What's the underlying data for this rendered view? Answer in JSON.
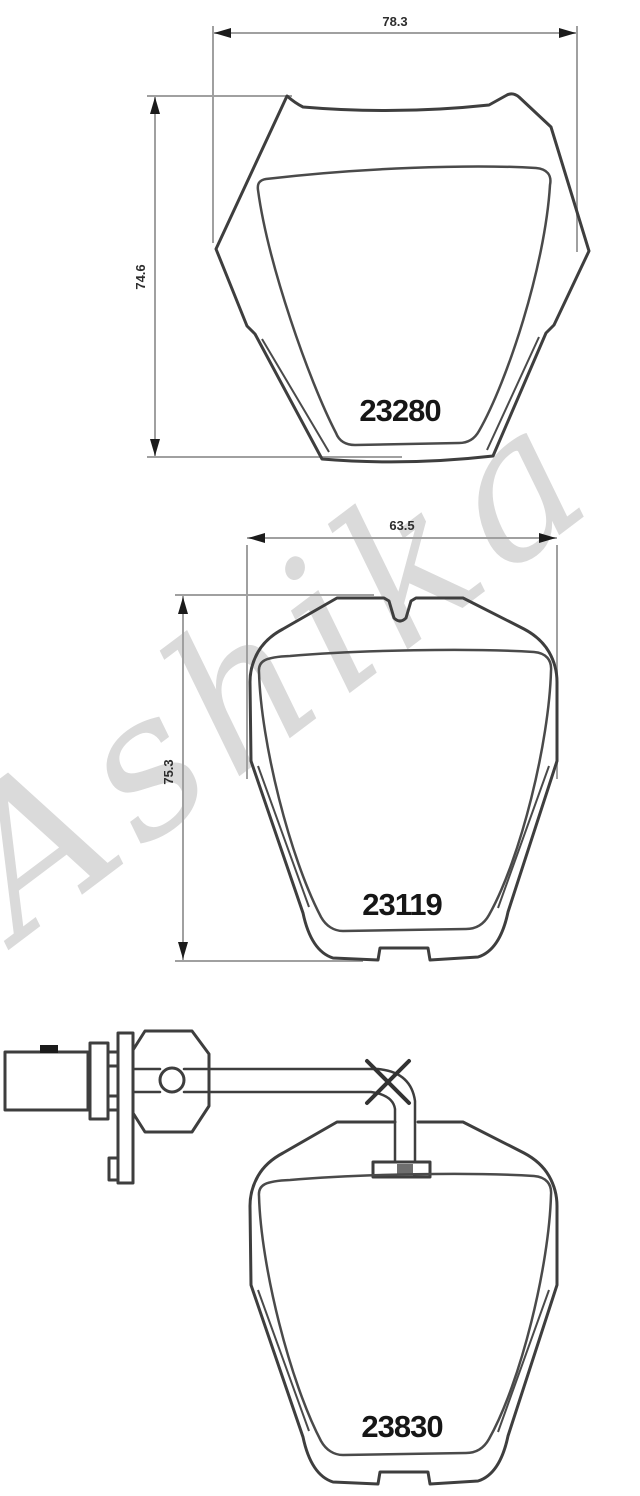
{
  "watermark": {
    "text": "Ashika",
    "color": "#dadada"
  },
  "pads": [
    {
      "part_number": "23280",
      "width_mm": "78.3",
      "height_mm": "74.6"
    },
    {
      "part_number": "23119",
      "width_mm": "63.5",
      "height_mm": "75.3"
    },
    {
      "part_number": "23830"
    }
  ]
}
